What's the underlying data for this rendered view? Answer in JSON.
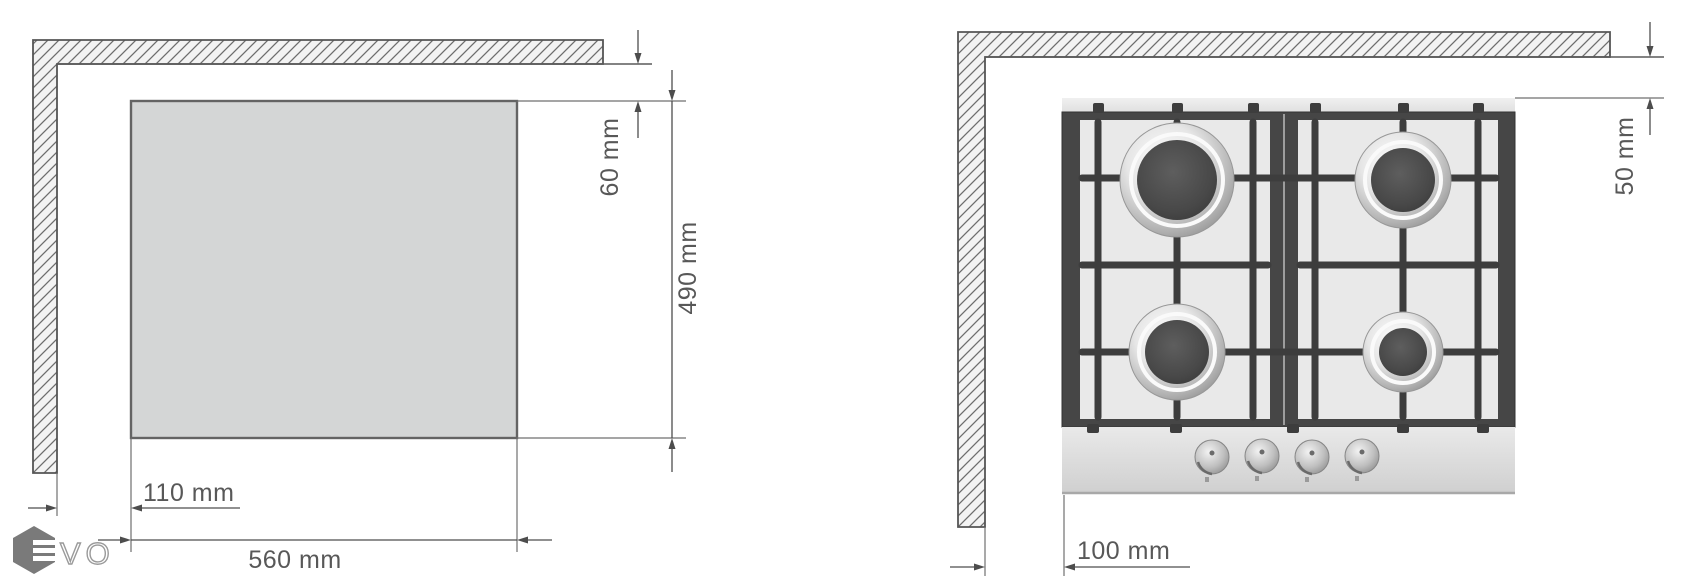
{
  "page": {
    "background": "#ffffff"
  },
  "left_diagram": {
    "description": "worktop cutout with hatched walls",
    "dim_top_gap": "60 mm",
    "dim_height": "490 mm",
    "dim_left_offset": "110 mm",
    "dim_width": "560 mm"
  },
  "right_diagram": {
    "description": "gas hob placement with hatched walls",
    "dim_top_gap": "50 mm",
    "dim_left_offset": "100 mm",
    "burner_count": 4,
    "knob_count": 4
  },
  "logo": {
    "mark": "hexagon-e-icon",
    "text": "VO"
  },
  "colors": {
    "line": "#4d4d4d",
    "extension_line": "#6f6f6f",
    "text": "#585858",
    "wall_fill": "#f3f3f3",
    "hatch": "#6e6e6e",
    "wall_border": "#555555",
    "cutout_fill": "#d4d6d6",
    "cutout_border": "#646464",
    "hob_frame": "#464646",
    "hob_surface": "#e9e9e9",
    "grid_bar": "#3d3d3d",
    "burner_center": "#4c4c4c",
    "chrome_ring": "#c9c9c9",
    "control_panel": "#d9d9d9",
    "logo_gray": "#7a7a7a"
  }
}
